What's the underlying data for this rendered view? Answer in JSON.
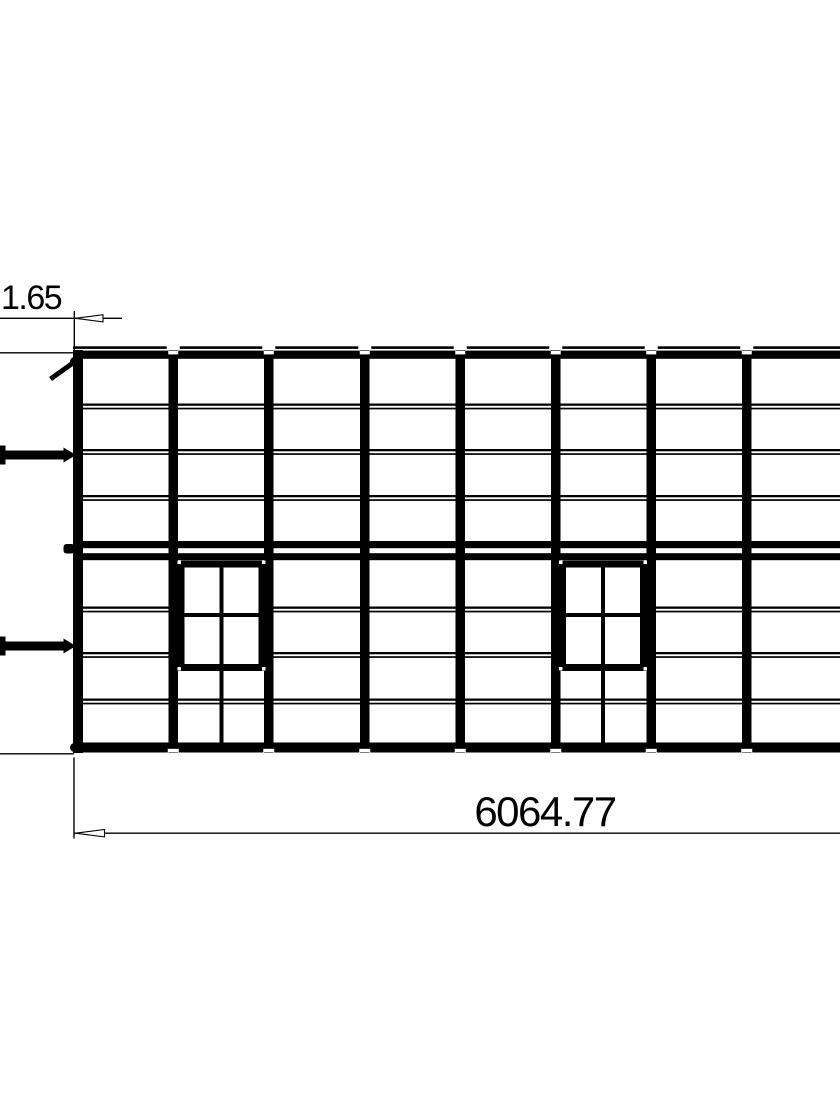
{
  "drawing": {
    "dimension_labels": {
      "top_left": "1.65",
      "overall_width": "6064.77"
    },
    "structure": {
      "visible_posts": 8,
      "upper_panel_rows": 4,
      "lower_panel_rows": 4,
      "windows": 2,
      "window_panes_per_window": 4
    },
    "colors": {
      "line": "#000000",
      "background": "#ffffff"
    }
  }
}
